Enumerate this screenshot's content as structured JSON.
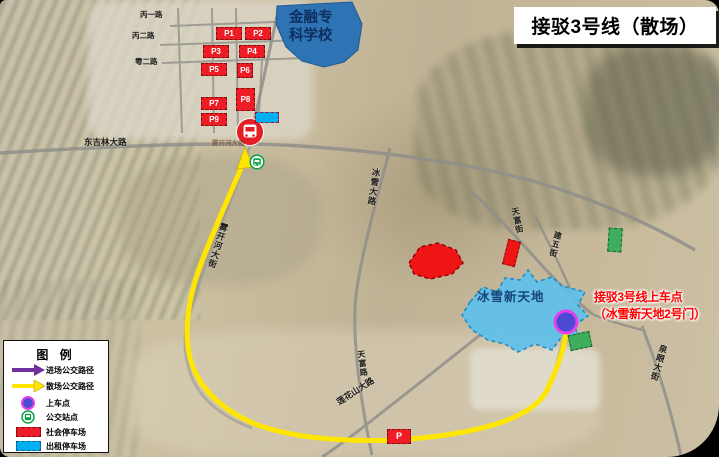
{
  "title": "接驳3号线（散场）",
  "school": {
    "line1": "金融专",
    "line2": "科学校"
  },
  "venue": {
    "label": "冰雪新天地"
  },
  "boarding_note": {
    "line1": "接驳3号线上车点",
    "line2": "（冰雪新天地2号门）"
  },
  "parking": {
    "p1": "P1",
    "p2": "P2",
    "p3": "P3",
    "p4": "P4",
    "p5": "P5",
    "p6": "P6",
    "p7": "P7",
    "p8": "P8",
    "p9": "P9",
    "roadside": "P"
  },
  "road_labels": {
    "bing_yi": "丙一路",
    "bing_er": "丙二路",
    "yu_er": "雩二路",
    "dongjilin": "东吉林大路",
    "wukaihe_small": "雾开河大街",
    "wukaihe": "雾开河大街",
    "bingxue": "冰雪大路",
    "tianfu_street": "天富街",
    "jianwu": "建五街",
    "tianfu_road": "天富路",
    "lianhuashan": "莲花山大路",
    "quanyan": "泉眼大街"
  },
  "legend": {
    "title": "图  例",
    "items": [
      {
        "name": "inbound-route",
        "label": "进场公交路径",
        "color": "#7030a0"
      },
      {
        "name": "outbound-route",
        "label": "散场公交路径",
        "color": "#ffe600"
      },
      {
        "name": "boarding-point",
        "label": "上车点",
        "color": "#4a4ad4"
      },
      {
        "name": "bus-stop",
        "label": "公交站点",
        "color": "#14a04a"
      },
      {
        "name": "public-parking",
        "label": "社会停车场",
        "color": "#ee1c25"
      },
      {
        "name": "taxi-parking",
        "label": "出租停车场",
        "color": "#00b0f0"
      }
    ]
  },
  "colors": {
    "route_yellow": "#ffe600",
    "parking_red": "#ee1c25",
    "school_blue": "#2e74b5",
    "venue_blue": "#5fc0ea",
    "boarding_blue": "#4a4ad4",
    "boarding_ring": "#e93ee9",
    "taxi_cyan": "#00b0f0",
    "note_red": "#ff0000"
  }
}
